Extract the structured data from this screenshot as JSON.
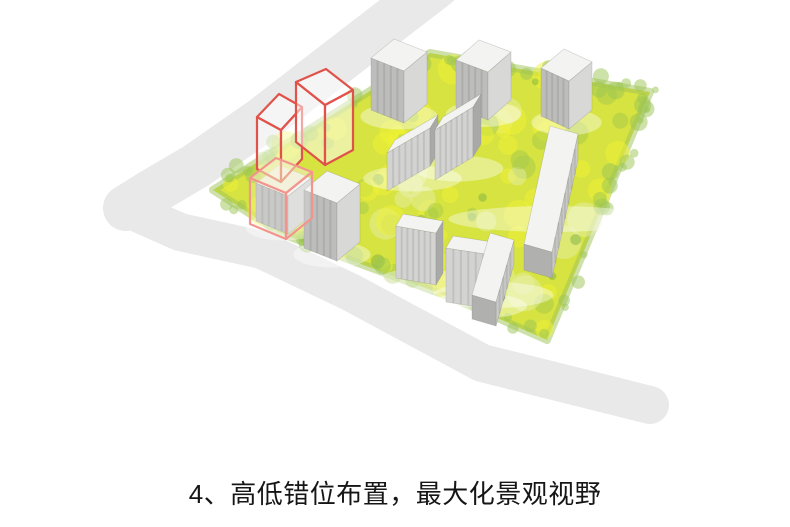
{
  "caption": {
    "text": "4、高低错位布置，最大化景观视野"
  },
  "scene": {
    "palette": {
      "background": "#ffffff",
      "road": "#e9e9e9",
      "grass": "#d6e340",
      "fringe": "#9fc457",
      "rooftop": "#f3f3f1",
      "ghost_red": "#e0524a",
      "ghost_pink": "#f2958e",
      "variants": {
        "tower": {
          "front": "#bdbdbb",
          "side": "#d8d8d6"
        },
        "slab": {
          "front": "#d3d3d1",
          "side": "#a9a9a7"
        },
        "slabE": {
          "front": "#c9c9c7",
          "side": "#b0b0ae"
        }
      }
    },
    "roads": [
      {
        "name": "road-northwest",
        "width": 46,
        "points": [
          [
            437,
            -15
          ],
          [
            350,
            52
          ],
          [
            262,
            120
          ],
          [
            196,
            166
          ],
          [
            150,
            193
          ],
          [
            126,
            208
          ]
        ]
      },
      {
        "name": "road-south",
        "width": 38,
        "points": [
          [
            126,
            208
          ],
          [
            180,
            232
          ],
          [
            262,
            250
          ],
          [
            352,
            293
          ],
          [
            482,
            363
          ],
          [
            650,
            405
          ]
        ]
      }
    ],
    "site": {
      "points": [
        [
          213,
          190
        ],
        [
          430,
          53
        ],
        [
          650,
          92
        ],
        [
          547,
          340
        ],
        [
          450,
          297
        ],
        [
          350,
          260
        ],
        [
          280,
          233
        ]
      ]
    },
    "texture": {
      "seed": 29,
      "count": 115,
      "kinds": [
        [
          "#eff233",
          0.5,
          6,
          16,
          0.5
        ],
        [
          "#a6c94c",
          0.5,
          5,
          12,
          0.25
        ],
        [
          "#e9efb4",
          0.45,
          8,
          18,
          0.12
        ],
        [
          "#7fb143",
          0.5,
          3,
          7,
          0.13
        ]
      ],
      "fringeCount": 70,
      "fringeColor": "#9cc654"
    },
    "buildings": [
      {
        "name": "tower-north-1",
        "p0": [
          371,
          58
        ],
        "a": [
          33,
          13
        ],
        "b": [
          23,
          -19
        ],
        "h": 52,
        "variant": "tower",
        "stripes": 4
      },
      {
        "name": "tower-north-2",
        "p0": [
          456,
          60
        ],
        "a": [
          32,
          12
        ],
        "b": [
          23,
          -20
        ],
        "h": 48,
        "variant": "tower",
        "stripes": 4
      },
      {
        "name": "tower-north-3",
        "p0": [
          541,
          68
        ],
        "a": [
          28,
          13
        ],
        "b": [
          23,
          -19
        ],
        "h": 48,
        "variant": "tower",
        "stripes": 4
      },
      {
        "name": "slab-center-upper-left",
        "p0": [
          387,
          153
        ],
        "a": [
          43,
          -25
        ],
        "b": [
          8,
          -13
        ],
        "h": 38,
        "variant": "slab",
        "stripes": 6
      },
      {
        "name": "slab-center-upper-right",
        "p0": [
          435,
          130
        ],
        "a": [
          38,
          -23
        ],
        "b": [
          8,
          -13
        ],
        "h": 50,
        "variant": "slab",
        "stripes": 6
      },
      {
        "name": "slab-east",
        "p0": [
          578,
          134
        ],
        "a": [
          -26,
          118
        ],
        "b": [
          -28,
          -8
        ],
        "h": 26,
        "variant": "slabE",
        "stripes": 7
      },
      {
        "name": "slab-center-lower-left",
        "p0": [
          396,
          226
        ],
        "a": [
          40,
          7
        ],
        "b": [
          7,
          -12
        ],
        "h": 52,
        "variant": "slab",
        "stripes": 6
      },
      {
        "name": "slab-center-lower-right",
        "p0": [
          446,
          248
        ],
        "a": [
          52,
          8
        ],
        "b": [
          7,
          -12
        ],
        "h": 54,
        "variant": "slab",
        "stripes": 6
      },
      {
        "name": "slab-southeast",
        "p0": [
          514,
          240
        ],
        "a": [
          -18,
          62
        ],
        "b": [
          -24,
          -7
        ],
        "h": 24,
        "variant": "slabE",
        "stripes": 4
      },
      {
        "name": "tower-west-low",
        "p0": [
          256,
          183
        ],
        "a": [
          32,
          13
        ],
        "b": [
          23,
          -18
        ],
        "h": 38,
        "variant": "tower",
        "stripes": 4
      },
      {
        "name": "tower-west-tall",
        "p0": [
          304,
          190
        ],
        "a": [
          33,
          13
        ],
        "b": [
          23,
          -19
        ],
        "h": 58,
        "variant": "tower",
        "stripes": 4
      }
    ],
    "wireframes": [
      {
        "name": "ghost-volume-left",
        "top": [
          [
            257,
            117
          ],
          [
            279,
            94
          ],
          [
            302,
            107
          ],
          [
            281,
            130
          ]
        ],
        "h": 52,
        "stroke": "#e0524a",
        "fill": "rgba(255,255,255,0.5)",
        "topFill": "rgba(255,255,255,0.55)"
      },
      {
        "name": "ghost-volume-right",
        "top": [
          [
            296,
            82
          ],
          [
            326,
            69
          ],
          [
            353,
            90
          ],
          [
            325,
            105
          ]
        ],
        "h": 60,
        "stroke": "#e0524a",
        "fill": "rgba(255,255,255,0.5)",
        "topFill": "rgba(255,255,255,0.55)"
      },
      {
        "name": "ghost-outline-low-tower",
        "top": [
          [
            250,
            178
          ],
          [
            276,
            158
          ],
          [
            312,
            172
          ],
          [
            286,
            193
          ]
        ],
        "h": 46,
        "stroke": "#f2958e",
        "fill": "rgba(255,255,255,0.18)",
        "topFill": "rgba(243,238,200,0.55)"
      }
    ]
  }
}
